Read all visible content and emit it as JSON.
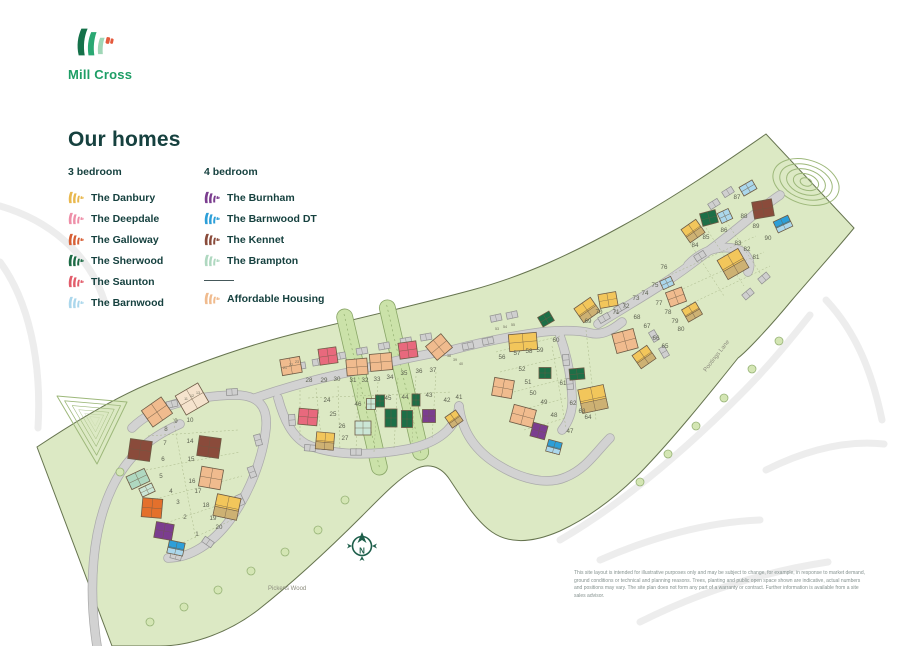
{
  "brand": {
    "name": "Mill Cross"
  },
  "legend": {
    "title": "Our homes",
    "columns": [
      {
        "heading": "3 bedroom",
        "items": [
          {
            "name": "The Danbury",
            "color": "#E9B84E"
          },
          {
            "name": "The Deepdale",
            "color": "#EE8FA8"
          },
          {
            "name": "The Galloway",
            "color": "#D75F35"
          },
          {
            "name": "The Sherwood",
            "color": "#1C6B45"
          },
          {
            "name": "The Saunton",
            "color": "#E25D6B"
          },
          {
            "name": "The Barnwood",
            "color": "#ABD7EC"
          }
        ]
      },
      {
        "heading": "4 bedroom",
        "items": [
          {
            "name": "The Burnham",
            "color": "#7B3D8F"
          },
          {
            "name": "The Barnwood DT",
            "color": "#2D9FD8"
          },
          {
            "name": "The Kennet",
            "color": "#8A4B3B"
          },
          {
            "name": "The Brampton",
            "color": "#AFD8C0"
          },
          {
            "name": "Affordable Housing",
            "color": "#F0BB8E",
            "divider_before": true
          }
        ]
      }
    ]
  },
  "map": {
    "labels": {
      "wood": "Pickens Wood",
      "lane": "Pootings Lane",
      "compass_letter": "N"
    },
    "disclaimer": "This site layout is intended for illustrative purposes only and may be subject to change, for example, in response to market demand, ground conditions or technical and planning reasons. Trees, planting and public open space shown are indicative, actual numbers and positions may vary. The site plan does not form any part of a warranty or contract. Further information is available from a site sales advisor.",
    "colors": {
      "site_green": "#DCE9C4",
      "site_border": "#66744F",
      "road": "#D2D2D2",
      "road_edge": "#ABABAB",
      "contour": "#9DB87A",
      "parcel_line": "#9FAE7E",
      "compass": "#1D5E4A"
    },
    "house_colors": {
      "danbury": "#F2C65B",
      "tan": "#CDB173",
      "deepdale": "#EE8FA8",
      "galloway": "#E4702C",
      "sherwood": "#1D6F47",
      "saunton": "#E8697D",
      "barnwood": "#ABD7EC",
      "burnham": "#7B3D8F",
      "barnwood_dt": "#2D9FD8",
      "kennet": "#8A4B3B",
      "brampton": "#AFD8C0",
      "brampton_light": "#CBE6D6",
      "affordable": "#F0BB8E",
      "cream": "#F5E3CD"
    },
    "houses": [
      {
        "x": 157,
        "y": 412,
        "w": 24,
        "h": 20,
        "r": -35,
        "c": "affordable"
      },
      {
        "x": 192,
        "y": 399,
        "w": 26,
        "h": 22,
        "r": -30,
        "c": "cream"
      },
      {
        "x": 140,
        "y": 450,
        "w": 22,
        "h": 20,
        "r": 8,
        "c": "kennet"
      },
      {
        "x": 209,
        "y": 447,
        "w": 22,
        "h": 20,
        "r": 8,
        "c": "kennet"
      },
      {
        "x": 138,
        "y": 479,
        "w": 20,
        "h": 14,
        "r": -25,
        "c": "brampton"
      },
      {
        "x": 147,
        "y": 490,
        "w": 14,
        "h": 9,
        "r": -25,
        "c": "brampton_light"
      },
      {
        "x": 211,
        "y": 478,
        "w": 22,
        "h": 20,
        "r": 10,
        "c": "affordable"
      },
      {
        "x": 227,
        "y": 507,
        "w": 24,
        "h": 22,
        "r": 12,
        "c": "danbury",
        "c2": "tan"
      },
      {
        "x": 152,
        "y": 508,
        "w": 20,
        "h": 19,
        "r": 5,
        "c": "galloway"
      },
      {
        "x": 164,
        "y": 531,
        "w": 18,
        "h": 16,
        "r": 10,
        "c": "burnham"
      },
      {
        "x": 176,
        "y": 548,
        "w": 16,
        "h": 13,
        "r": 12,
        "c": "barnwood_dt",
        "c2": "barnwood"
      },
      {
        "x": 291,
        "y": 366,
        "w": 20,
        "h": 16,
        "r": -10,
        "c": "affordable"
      },
      {
        "x": 328,
        "y": 356,
        "w": 18,
        "h": 16,
        "r": -8,
        "c": "saunton"
      },
      {
        "x": 357,
        "y": 367,
        "w": 21,
        "h": 16,
        "r": -5,
        "c": "affordable"
      },
      {
        "x": 381,
        "y": 362,
        "w": 22,
        "h": 17,
        "r": -5,
        "c": "affordable"
      },
      {
        "x": 408,
        "y": 350,
        "w": 18,
        "h": 16,
        "r": -8,
        "c": "saunton"
      },
      {
        "x": 439,
        "y": 347,
        "w": 20,
        "h": 18,
        "r": -40,
        "c": "affordable"
      },
      {
        "x": 308,
        "y": 417,
        "w": 19,
        "h": 16,
        "r": 5,
        "c": "saunton"
      },
      {
        "x": 325,
        "y": 441,
        "w": 18,
        "h": 17,
        "r": 5,
        "c": "danbury",
        "c2": "tan"
      },
      {
        "x": 363,
        "y": 428,
        "w": 16,
        "h": 14,
        "r": 0,
        "c": "brampton_light"
      },
      {
        "x": 371,
        "y": 404,
        "w": 9,
        "h": 11,
        "r": 0,
        "c": "brampton_light"
      },
      {
        "x": 380,
        "y": 401,
        "w": 9,
        "h": 12,
        "r": 0,
        "c": "sherwood"
      },
      {
        "x": 391,
        "y": 418,
        "w": 12,
        "h": 18,
        "r": 0,
        "c": "sherwood"
      },
      {
        "x": 407,
        "y": 419,
        "w": 11,
        "h": 17,
        "r": 0,
        "c": "sherwood"
      },
      {
        "x": 416,
        "y": 400,
        "w": 8,
        "h": 12,
        "r": 0,
        "c": "sherwood"
      },
      {
        "x": 429,
        "y": 416,
        "w": 13,
        "h": 13,
        "r": 0,
        "c": "burnham"
      },
      {
        "x": 454,
        "y": 419,
        "w": 13,
        "h": 13,
        "r": -35,
        "c": "danbury",
        "c2": "tan"
      },
      {
        "x": 523,
        "y": 342,
        "w": 28,
        "h": 17,
        "r": -5,
        "c": "danbury"
      },
      {
        "x": 546,
        "y": 319,
        "w": 13,
        "h": 11,
        "r": -30,
        "c": "sherwood"
      },
      {
        "x": 587,
        "y": 310,
        "w": 20,
        "h": 17,
        "r": -35,
        "c": "danbury",
        "c2": "tan"
      },
      {
        "x": 608,
        "y": 300,
        "w": 18,
        "h": 14,
        "r": -10,
        "c": "danbury"
      },
      {
        "x": 625,
        "y": 341,
        "w": 22,
        "h": 20,
        "r": -15,
        "c": "affordable"
      },
      {
        "x": 644,
        "y": 357,
        "w": 18,
        "h": 16,
        "r": -35,
        "c": "danbury",
        "c2": "tan"
      },
      {
        "x": 503,
        "y": 388,
        "w": 20,
        "h": 18,
        "r": 10,
        "c": "affordable"
      },
      {
        "x": 545,
        "y": 373,
        "w": 12,
        "h": 11,
        "r": 0,
        "c": "sherwood"
      },
      {
        "x": 577,
        "y": 374,
        "w": 15,
        "h": 11,
        "r": -5,
        "c": "sherwood"
      },
      {
        "x": 593,
        "y": 399,
        "w": 26,
        "h": 24,
        "r": -12,
        "c": "danbury",
        "c2": "tan"
      },
      {
        "x": 523,
        "y": 416,
        "w": 23,
        "h": 18,
        "r": 15,
        "c": "affordable"
      },
      {
        "x": 539,
        "y": 431,
        "w": 15,
        "h": 14,
        "r": 15,
        "c": "burnham"
      },
      {
        "x": 554,
        "y": 447,
        "w": 14,
        "h": 12,
        "r": 15,
        "c": "barnwood_dt",
        "c2": "barnwood"
      },
      {
        "x": 748,
        "y": 188,
        "w": 15,
        "h": 10,
        "r": -30,
        "c": "barnwood"
      },
      {
        "x": 763,
        "y": 209,
        "w": 20,
        "h": 17,
        "r": -10,
        "c": "kennet"
      },
      {
        "x": 783,
        "y": 224,
        "w": 16,
        "h": 12,
        "r": -25,
        "c": "barnwood_dt",
        "c2": "barnwood"
      },
      {
        "x": 709,
        "y": 218,
        "w": 16,
        "h": 13,
        "r": -15,
        "c": "sherwood"
      },
      {
        "x": 725,
        "y": 216,
        "w": 12,
        "h": 11,
        "r": -25,
        "c": "barnwood"
      },
      {
        "x": 693,
        "y": 231,
        "w": 18,
        "h": 16,
        "r": -35,
        "c": "danbury",
        "c2": "tan"
      },
      {
        "x": 733,
        "y": 264,
        "w": 24,
        "h": 22,
        "r": -30,
        "c": "danbury",
        "c2": "tan"
      },
      {
        "x": 667,
        "y": 283,
        "w": 12,
        "h": 9,
        "r": -25,
        "c": "barnwood"
      },
      {
        "x": 676,
        "y": 297,
        "w": 17,
        "h": 15,
        "r": -20,
        "c": "affordable"
      },
      {
        "x": 692,
        "y": 312,
        "w": 16,
        "h": 14,
        "r": -30,
        "c": "danbury",
        "c2": "tan"
      }
    ],
    "plots": [
      {
        "n": 1,
        "x": 197,
        "y": 536
      },
      {
        "n": 2,
        "x": 185,
        "y": 519
      },
      {
        "n": 3,
        "x": 178,
        "y": 504
      },
      {
        "n": 4,
        "x": 171,
        "y": 493
      },
      {
        "n": 5,
        "x": 161,
        "y": 478
      },
      {
        "n": 6,
        "x": 163,
        "y": 461
      },
      {
        "n": 7,
        "x": 165,
        "y": 445
      },
      {
        "n": 8,
        "x": 166,
        "y": 431
      },
      {
        "n": 9,
        "x": 176,
        "y": 423
      },
      {
        "n": 10,
        "x": 190,
        "y": 422
      },
      {
        "n": 11,
        "x": 186,
        "y": 400,
        "s": 1
      },
      {
        "n": 12,
        "x": 192,
        "y": 397,
        "s": 1
      },
      {
        "n": 13,
        "x": 198,
        "y": 394,
        "s": 1
      },
      {
        "n": 14,
        "x": 190,
        "y": 443
      },
      {
        "n": 15,
        "x": 191,
        "y": 461
      },
      {
        "n": 16,
        "x": 192,
        "y": 483
      },
      {
        "n": 17,
        "x": 198,
        "y": 493
      },
      {
        "n": 18,
        "x": 206,
        "y": 507
      },
      {
        "n": 19,
        "x": 213,
        "y": 520
      },
      {
        "n": 20,
        "x": 219,
        "y": 529
      },
      {
        "n": 21,
        "x": 285,
        "y": 369,
        "s": 1
      },
      {
        "n": 22,
        "x": 291,
        "y": 366,
        "s": 1
      },
      {
        "n": 23,
        "x": 297,
        "y": 363,
        "s": 1
      },
      {
        "n": 24,
        "x": 327,
        "y": 402
      },
      {
        "n": 25,
        "x": 333,
        "y": 416
      },
      {
        "n": 26,
        "x": 342,
        "y": 428
      },
      {
        "n": 27,
        "x": 345,
        "y": 440
      },
      {
        "n": 28,
        "x": 309,
        "y": 382
      },
      {
        "n": 29,
        "x": 324,
        "y": 382
      },
      {
        "n": 30,
        "x": 337,
        "y": 381
      },
      {
        "n": 31,
        "x": 353,
        "y": 382
      },
      {
        "n": 32,
        "x": 365,
        "y": 382
      },
      {
        "n": 33,
        "x": 377,
        "y": 381
      },
      {
        "n": 34,
        "x": 390,
        "y": 379
      },
      {
        "n": 35,
        "x": 404,
        "y": 375
      },
      {
        "n": 36,
        "x": 419,
        "y": 373
      },
      {
        "n": 37,
        "x": 433,
        "y": 372
      },
      {
        "n": 38,
        "x": 449,
        "y": 357,
        "s": 1
      },
      {
        "n": 39,
        "x": 455,
        "y": 361,
        "s": 1
      },
      {
        "n": 40,
        "x": 461,
        "y": 365,
        "s": 1
      },
      {
        "n": 41,
        "x": 459,
        "y": 399
      },
      {
        "n": 42,
        "x": 447,
        "y": 402
      },
      {
        "n": 43,
        "x": 429,
        "y": 397
      },
      {
        "n": 44,
        "x": 405,
        "y": 399
      },
      {
        "n": 45,
        "x": 388,
        "y": 400
      },
      {
        "n": 46,
        "x": 358,
        "y": 406
      },
      {
        "n": 47,
        "x": 570,
        "y": 433
      },
      {
        "n": 48,
        "x": 554,
        "y": 417
      },
      {
        "n": 49,
        "x": 544,
        "y": 404
      },
      {
        "n": 50,
        "x": 533,
        "y": 395
      },
      {
        "n": 51,
        "x": 528,
        "y": 384
      },
      {
        "n": 52,
        "x": 522,
        "y": 371
      },
      {
        "n": 53,
        "x": 497,
        "y": 330,
        "s": 1
      },
      {
        "n": 54,
        "x": 505,
        "y": 328,
        "s": 1
      },
      {
        "n": 55,
        "x": 513,
        "y": 326,
        "s": 1
      },
      {
        "n": 56,
        "x": 502,
        "y": 359
      },
      {
        "n": 57,
        "x": 517,
        "y": 355
      },
      {
        "n": 58,
        "x": 529,
        "y": 353
      },
      {
        "n": 59,
        "x": 540,
        "y": 352
      },
      {
        "n": 60,
        "x": 556,
        "y": 342
      },
      {
        "n": 61,
        "x": 563,
        "y": 385
      },
      {
        "n": 62,
        "x": 573,
        "y": 405
      },
      {
        "n": 63,
        "x": 582,
        "y": 413
      },
      {
        "n": 64,
        "x": 588,
        "y": 419
      },
      {
        "n": 65,
        "x": 665,
        "y": 348
      },
      {
        "n": 66,
        "x": 656,
        "y": 340
      },
      {
        "n": 67,
        "x": 647,
        "y": 328
      },
      {
        "n": 68,
        "x": 637,
        "y": 319
      },
      {
        "n": 69,
        "x": 588,
        "y": 323
      },
      {
        "n": 70,
        "x": 599,
        "y": 314
      },
      {
        "n": 71,
        "x": 616,
        "y": 314
      },
      {
        "n": 72,
        "x": 626,
        "y": 308
      },
      {
        "n": 73,
        "x": 636,
        "y": 300
      },
      {
        "n": 74,
        "x": 645,
        "y": 295
      },
      {
        "n": 75,
        "x": 655,
        "y": 287
      },
      {
        "n": 76,
        "x": 664,
        "y": 269
      },
      {
        "n": 77,
        "x": 659,
        "y": 305
      },
      {
        "n": 78,
        "x": 668,
        "y": 314
      },
      {
        "n": 79,
        "x": 675,
        "y": 323
      },
      {
        "n": 80,
        "x": 681,
        "y": 331
      },
      {
        "n": 81,
        "x": 756,
        "y": 259
      },
      {
        "n": 82,
        "x": 747,
        "y": 251
      },
      {
        "n": 83,
        "x": 738,
        "y": 245
      },
      {
        "n": 84,
        "x": 695,
        "y": 247
      },
      {
        "n": 85,
        "x": 706,
        "y": 239
      },
      {
        "n": 86,
        "x": 724,
        "y": 232
      },
      {
        "n": 87,
        "x": 737,
        "y": 199
      },
      {
        "n": 88,
        "x": 744,
        "y": 218
      },
      {
        "n": 89,
        "x": 756,
        "y": 228
      },
      {
        "n": 90,
        "x": 768,
        "y": 240
      }
    ]
  }
}
